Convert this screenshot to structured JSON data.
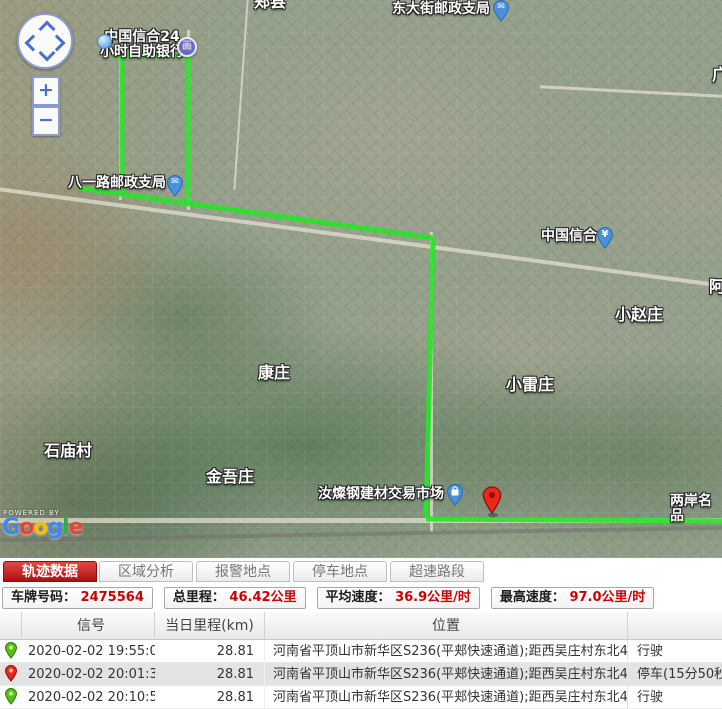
{
  "map": {
    "labels": [
      {
        "text": "郏县"
      },
      {
        "text": "东大街邮政支局"
      },
      {
        "text": "广"
      },
      {
        "text": "中国信合24\n小时自助银行"
      },
      {
        "text": "八一路邮政支局"
      },
      {
        "text": "中国信合"
      },
      {
        "text": "小赵庄"
      },
      {
        "text": "阿"
      },
      {
        "text": "康庄"
      },
      {
        "text": "小雷庄"
      },
      {
        "text": "石庙村"
      },
      {
        "text": "金吾庄"
      },
      {
        "text": "汝燦钢建材交易市场"
      },
      {
        "text": "两岸名品"
      }
    ],
    "icons": {
      "postal": "✉",
      "yen": "¥",
      "atm": "画",
      "zoom_in": "+",
      "zoom_out": "−"
    },
    "route_color": "#2ae32a",
    "attribution": {
      "powered_by": "POWERED BY",
      "logo": [
        "G",
        "o",
        "o",
        "g",
        "l",
        "e"
      ],
      "logo_colors": [
        "#4285F4",
        "#EA4335",
        "#FBBC05",
        "#4285F4",
        "#34A853",
        "#EA4335"
      ]
    }
  },
  "tabs": [
    {
      "label": "轨迹数据",
      "active": true
    },
    {
      "label": "区域分析",
      "active": false
    },
    {
      "label": "报警地点",
      "active": false
    },
    {
      "label": "停车地点",
      "active": false
    },
    {
      "label": "超速路段",
      "active": false
    }
  ],
  "stats": [
    {
      "label": "车牌号码：",
      "value": "2475564"
    },
    {
      "label": "总里程：",
      "value": "46.42公里"
    },
    {
      "label": "平均速度：",
      "value": "36.9公里/时"
    },
    {
      "label": "最高速度：",
      "value": "97.0公里/时"
    }
  ],
  "table": {
    "headers": {
      "signal": "信号",
      "mileage": "当日里程(km)",
      "location": "位置"
    },
    "rows": [
      {
        "pin": "green",
        "time": "2020-02-02 19:55:06",
        "mileage": "28.81",
        "location": "河南省平顶山市新华区S236(平郏快速通道);距西吴庄村东北46",
        "status": "行驶"
      },
      {
        "pin": "red",
        "time": "2020-02-02 20:01:33",
        "mileage": "28.81",
        "location": "河南省平顶山市新华区S236(平郏快速通道);距西吴庄村东北46",
        "status": "停车(15分50秒)"
      },
      {
        "pin": "green",
        "time": "2020-02-02 20:10:55",
        "mileage": "28.81",
        "location": "河南省平顶山市新华区S236(平郏快速通道);距西吴庄村东北46",
        "status": "行驶"
      }
    ]
  }
}
